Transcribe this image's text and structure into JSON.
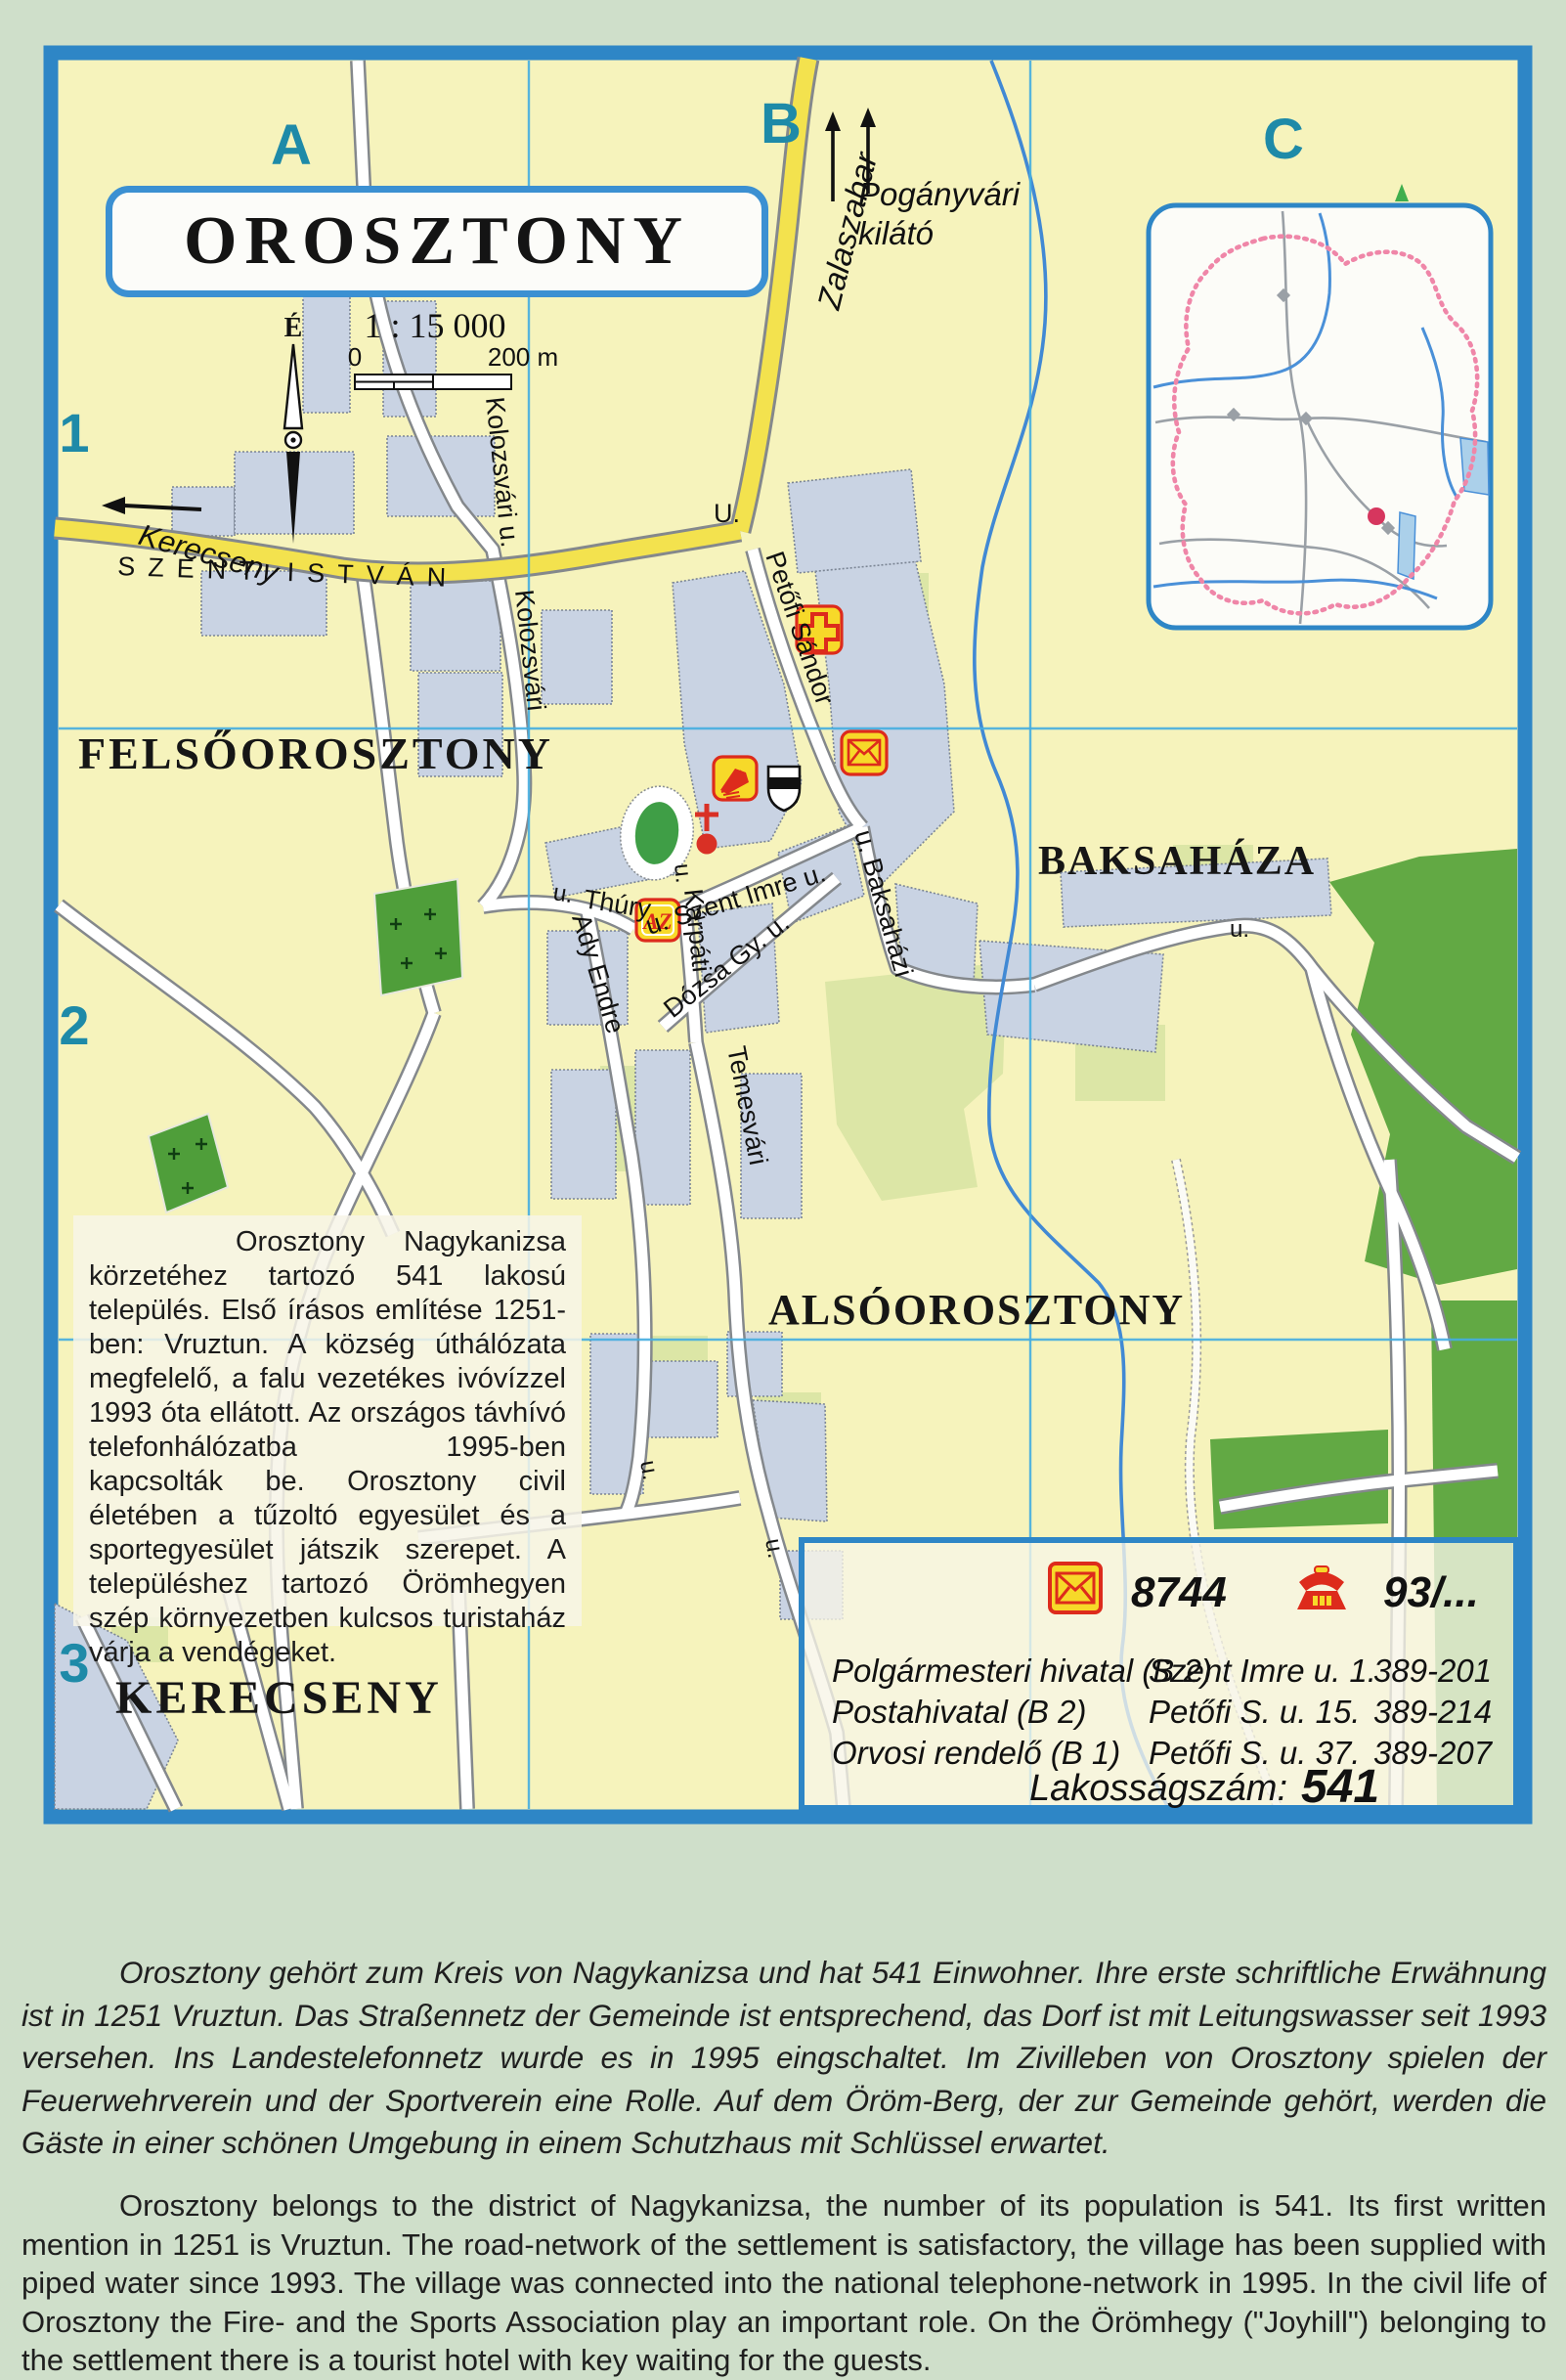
{
  "map": {
    "title": "OROSZTONY",
    "scale_ratio": "1 : 15 000",
    "scale_zero": "0",
    "scale_distance": "200 m",
    "compass_north": "É",
    "grid_columns": [
      "A",
      "B",
      "C"
    ],
    "grid_rows": [
      "1",
      "2",
      "3"
    ],
    "direction_labels": {
      "west_neighbor": "Kerecseny",
      "north_road": "Zalaszabar",
      "lookout_line1": "Pogányvári",
      "lookout_line2": "kilátó"
    },
    "settlement_labels": {
      "felsoorosztony": "FELSŐOROSZTONY",
      "baksahaza": "BAKSAHÁZA",
      "alsoorosztony": "ALSÓOROSZTONY",
      "kerecseny": "KERECSENY"
    },
    "street_labels": {
      "szent_istvan": "SZENT ISTVÁN",
      "szent_istvan_u": "U.",
      "kolozsvari_u": "Kolozsvári u.",
      "kolozsvari": "Kolozsvári",
      "petofi_sandor": "Petőfi Sándor",
      "thury_u": "u.",
      "thury": "Thúry",
      "ady_endre": "Ady Endre",
      "szent_imre": "u. Szent Imre u.",
      "karpati_u": "u.",
      "karpati": "Kárpáti",
      "dozsa": "Dózsa Gy.  u.",
      "baksahazi": "u. Baksaházi",
      "temesvari": "Temesvári",
      "baksahaza_road_u": "u.",
      "temesvari_u1": "u.",
      "temesvari_u2": "u."
    },
    "shop_icon_text": "AZ",
    "icons": [
      "medical-cross-icon",
      "post-envelope-icon",
      "library-book-icon",
      "coat-of-arms-shield-icon",
      "church-cross-icon",
      "az-shop-icon",
      "sports-field",
      "cemetery-crosses",
      "location-red-dot"
    ],
    "colors": {
      "map_bg": "#f6f3bc",
      "border_blue": "#2e86c6",
      "grid_cyan": "#45aee0",
      "road_yellow": "#f3e24e",
      "building_fill": "#c9d3e3",
      "forest_green": "#62a944",
      "river_blue": "#4189d4",
      "label_teal": "#1e8aa8",
      "icon_yellow": "#f7d929",
      "icon_red": "#dd2b1c",
      "boundary_pink": "#ef86a8"
    }
  },
  "description_hu": "Orosztony Nagykanizsa körzetéhez tartozó 541 lakosú település. Első írásos említése 1251-ben: Vruztun. A község úthálózata megfelelő, a falu vezetékes ivóvízzel 1993 óta ellátott. Az országos távhívó telefonhálózatba 1995-ben kapcsolták be. Orosztony civil életében a tűzoltó egyesület és a sportegyesület játszik szerepet. A településhez tartozó Örömhegyen szép környezetben kulcsos turistaház várja a vendégeket.",
  "info_box": {
    "postal_code": "8744",
    "phone_prefix": "93/...",
    "entries": [
      {
        "name": "Polgármesteri hivatal (B 2)",
        "address": "Szent Imre u. 1.",
        "phone": "389-201"
      },
      {
        "name": "Postahivatal (B 2)",
        "address": "Petőfi S. u. 15.",
        "phone": "389-214"
      },
      {
        "name": "Orvosi rendelő (B 1)",
        "address": "Petőfi S. u. 37.",
        "phone": "389-207"
      }
    ],
    "population_label": "Lakosságszám:",
    "population_value": "541"
  },
  "paragraph_de": "Orosztony gehört zum Kreis von Nagykanizsa und hat 541 Einwohner. Ihre erste schriftliche Erwähnung ist in 1251 Vruztun. Das Straßennetz der Gemeinde ist entsprechend, das Dorf ist mit Leitungswasser seit 1993 versehen. Ins Landestelefonnetz wurde es in 1995 eingschaltet. Im Zivilleben von Orosztony spielen der Feuerwehrverein und der Sportverein eine Rolle. Auf dem Öröm-Berg, der zur Gemeinde gehört, werden die Gäste in einer schönen Umgebung in einem Schutzhaus mit Schlüssel erwartet.",
  "paragraph_en": "Orosztony belongs to the district of Nagykanizsa, the number of its population is 541. Its first written mention in 1251 is Vruztun. The road-network of the settlement is satisfactory, the village has been supplied with piped water since 1993. The village was connected into the national telephone-network in 1995. In the civil life of Orosztony the Fire- and the Sports Association play an important role. On the Örömhegy (\"Joyhill\") belonging to the settlement there is a tourist hotel with key waiting for the guests."
}
